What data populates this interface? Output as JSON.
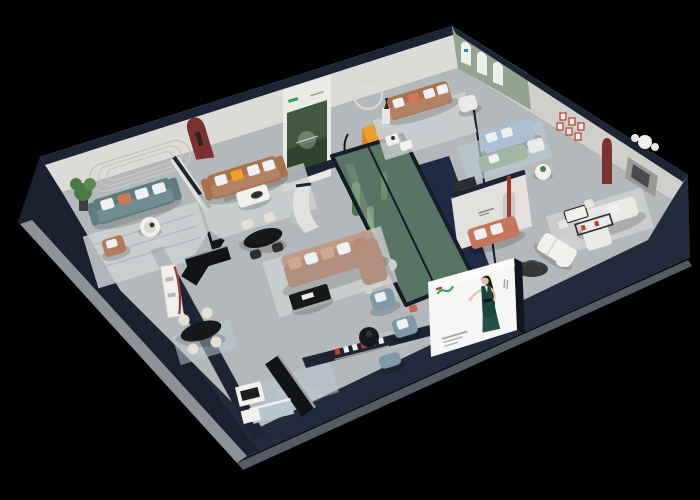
{
  "scene": {
    "title": "Isometric cutaway 3D render of a furniture showroom floor plan on a black background",
    "type": "3d-floorplan-render",
    "legible_text": "none — all logos, posters and wall signs are too small to read"
  },
  "palette": {
    "background": "#000000",
    "outer_wall": "#222b3c",
    "outer_wall_dark": "#171e2c",
    "wall_top": "#1d2535",
    "plinth_left": "#8e9296",
    "plinth_right": "#565b61",
    "floor": "#b5b8ba",
    "wall_back_left": "#dcdbd8",
    "wall_back_right": "#cfcfcc",
    "wall_panel": "#e2e1de",
    "molding": "#c6c5c2",
    "green_wall": "#93a391",
    "arch_white": "#eef0ec",
    "forest_dark": "#41583f",
    "poster_white": "#eceae6",
    "logo_green": "#2f9e5a",
    "logo_red": "#c0392b",
    "niche_red": "#7c3131",
    "frame_red": "#b5372c",
    "sofa_teal": "#5e7d83",
    "sofa_brown": "#a9714e",
    "sofa_tan": "#b28f7e",
    "sofa_tan_back": "#bf9c8a",
    "sofa_blue": "#aabfd4",
    "sofa_sage": "#a3b7a5",
    "sofa_white": "#eae9e6",
    "sofa_terracotta": "#c5765b",
    "armchair_gray_blue": "#7e9aa8",
    "caramel": "#b07a5c",
    "mint": "#b2c7bd",
    "pillow_white": "#eef0f2",
    "pillow_orange": "#f0a02a",
    "pillow_rust": "#cd7a54",
    "table_black": "#17181a",
    "table_white": "#f1f0ed",
    "wood_dark": "#121316",
    "glass_green": "#bcd3d3",
    "atrium_green": "#33503a",
    "plant_green": "#4c7a46",
    "plant_light": "#5d8a52",
    "flower_white": "#ccd6c6",
    "stair_orange": "#ef9c2e",
    "red_column": "#a4352c",
    "rug_light": "#cdd1d2",
    "rug_blue": "#b7c8d2",
    "rug_dark": "#26282a",
    "billboard_white": "#f6f6f4",
    "billboard_edge": "#10151f",
    "dress_green": "#16483e",
    "hair_black": "#1d1713",
    "skin": "#eac2a8",
    "sign_red": "#c23b2e",
    "sign_white": "#eceff2",
    "metal": "#9aa0a8",
    "kitchen_blue": "#b9c5cd"
  },
  "areas": {
    "top_left_lounge": "teal sofa lounge with oval wall molding and plant",
    "left_lounge": "brown leather sofa room with dark red arch niche and forest poster panel",
    "top_lounge": "brown sofa room with statue, ring lamp and orange staircase",
    "arch_gallery": "sage green wall with three white arched banners",
    "blue_lounge": "light blue and sage sofas with round side table",
    "right_lounge": "partition wall with illegible logo, red column and terracotta sofa",
    "far_right_room": "white sofa set, dining nook, red picture-frame grid and dark red niche",
    "center_lounge": "large tan sectional sofa with black coffee table and glass plant atrium",
    "bottom_left_dining": "white shelf with red trim, black oval table with cream chairs",
    "bottom_showroom": "black display benches, white cabinet and pale blue kitchen counter",
    "billboard_corner": "gray-blue armchairs facing a large white billboard"
  },
  "billboard": {
    "subject": "woman with long black hair in a dark green dress, one arm extended",
    "logo": "small green cursive logo with a red mark, illegible",
    "caption": "three short gray text lines, illegible"
  },
  "signs": {
    "bottom_wall_sign": "row of small white and red CJK characters, illegible",
    "right_room_sign": "dark shelf frame with small red and white characters, illegible"
  }
}
